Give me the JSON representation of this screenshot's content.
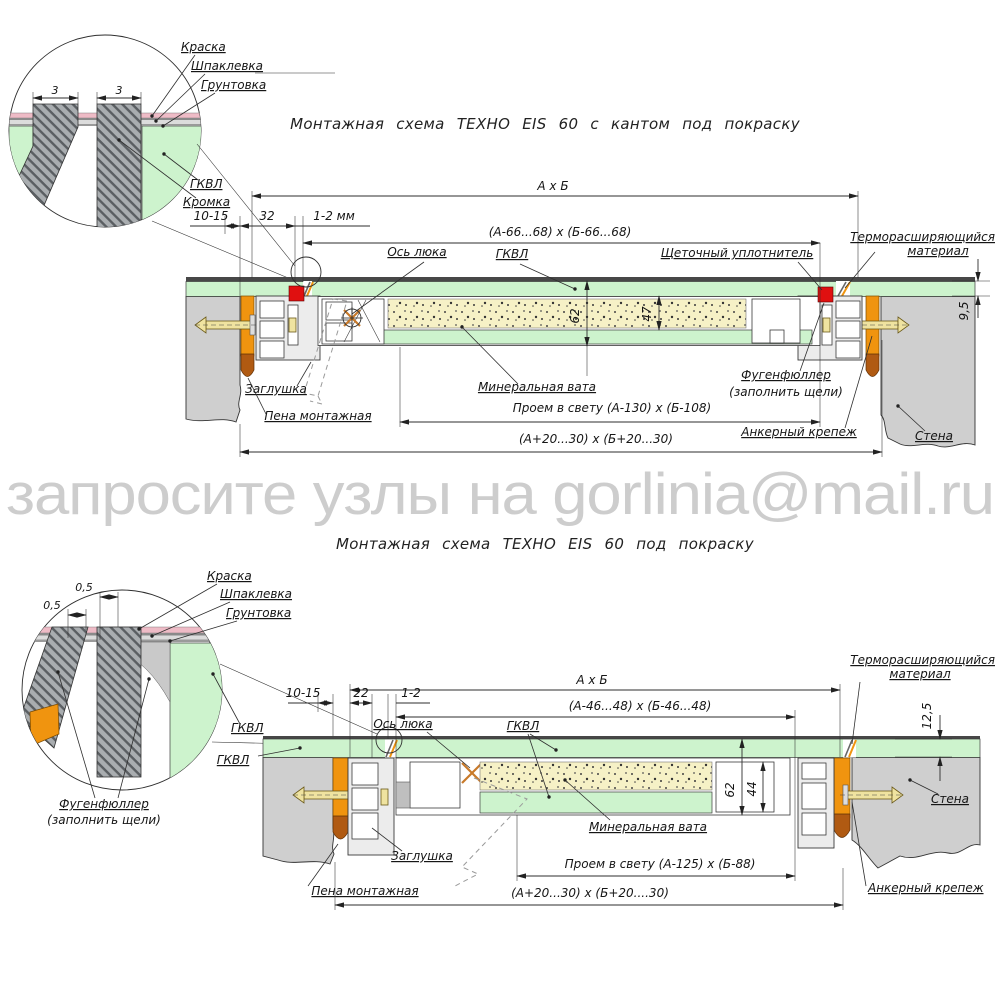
{
  "watermark": "запросите узлы на gorlinia@mail.ru",
  "colors": {
    "gkvl_green": "#cdf3cd",
    "mineral_wool": "#f6f1c6",
    "thermo_orange": "#f0940f",
    "foam_brown": "#b05a12",
    "seal_red": "#e01010",
    "wall_gray": "#cfcfcf",
    "paint_pink": "#eebbc6",
    "anchor_khaki": "#efe3a0",
    "line": "#2e2e2e",
    "watermark_gray": "#cdcdcd"
  },
  "top": {
    "title": "Монтажная схема ТЕХНО EIS 60 с кантом под покраску",
    "detail": {
      "dim_left": "3",
      "dim_right": "3",
      "paint": "Краска",
      "putty": "Шпаклевка",
      "primer": "Грунтовка",
      "gkvl": "ГКВЛ",
      "edge": "Кромка"
    },
    "dims": {
      "overall": "А х Б",
      "wall_gap": "10-15",
      "frame_width": "32",
      "leaf_gap": "1-2 мм",
      "leaf": "(А-66...68) х (Б-66...68)",
      "clear_opening": "Проем в свету (А-130) х (Б-108)",
      "mounting": "(А+20...30) х (Б+20...30)",
      "thickness": "62",
      "wool_thickness": "47",
      "board_thickness": "9,5"
    },
    "labels": {
      "axis": "Ось люка",
      "gkvl": "ГКВЛ",
      "brush_seal": "Щеточный уплотнитель",
      "thermo_line1": "Терморасширяющийся",
      "thermo_line2": "материал",
      "plug": "Заглушка",
      "wool": "Минеральная вата",
      "fugen_line1": "Фугенфюллер",
      "fugen_line2": "(заполнить щели)",
      "foam": "Пена монтажная",
      "anchor": "Анкерный крепеж",
      "wall": "Стена"
    }
  },
  "bottom": {
    "title": "Монтажная схема ТЕХНО EIS 60 под покраску",
    "detail": {
      "dim_top": "0,5",
      "dim_left": "0,5",
      "paint": "Краска",
      "putty": "Шпаклевка",
      "primer": "Грунтовка",
      "gkvl": "ГКВЛ",
      "fugen_line1": "Фугенфюллер",
      "fugen_line2": "(заполнить щели)"
    },
    "dims": {
      "overall": "А х Б",
      "wall_gap": "10-15",
      "frame_width": "22",
      "leaf_gap": "1-2",
      "leaf": "(А-46...48) х (Б-46...48)",
      "clear_opening": "Проем в свету (А-125) х (Б-88)",
      "mounting": "(А+20...30) х (Б+20....30)",
      "thickness": "62",
      "inner_height": "44",
      "board_thickness": "12,5"
    },
    "labels": {
      "axis": "Ось люка",
      "gkvl": "ГКВЛ",
      "gkvl_ceiling": "ГКВЛ",
      "thermo_line1": "Терморасширяющийся",
      "thermo_line2": "материал",
      "plug": "Заглушка",
      "wool": "Минеральная вата",
      "foam": "Пена монтажная",
      "anchor": "Анкерный крепеж",
      "wall": "Стена"
    }
  }
}
